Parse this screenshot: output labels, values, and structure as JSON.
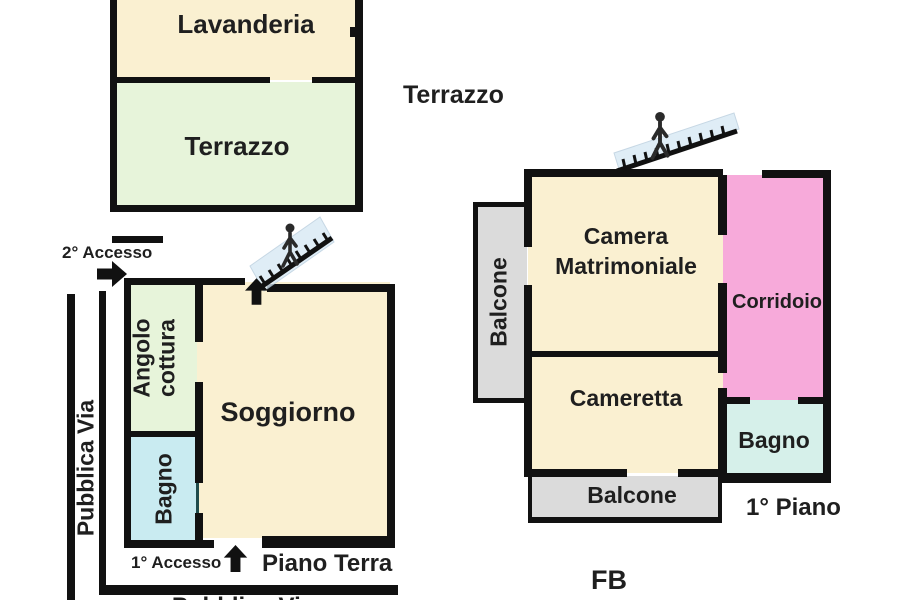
{
  "labels": {
    "lavanderia": "Lavanderia",
    "terrazzo_room": "Terrazzo",
    "terrazzo_outer": "Terrazzo",
    "accesso2": "2° Accesso",
    "accesso1": "1° Accesso",
    "pubblica_via_left": "Pubblica Via",
    "pubblica_via_bottom": "Pubblica Via",
    "angolo_line1": "Angolo",
    "angolo_line2": "cottura",
    "soggiorno": "Soggiorno",
    "bagno_ground": "Bagno",
    "piano_terra": "Piano Terra",
    "balcone_left": "Balcone",
    "camera_line1": "Camera",
    "camera_line2": "Matrimoniale",
    "cameretta": "Cameretta",
    "corridoio": "Corridoio",
    "bagno_first": "Bagno",
    "balcone_bottom": "Balcone",
    "piano_primo": "1° Piano",
    "signature": "FB"
  },
  "colors": {
    "wall": "#111111",
    "text": "#1f1f1f",
    "cream": "#FAF0D1",
    "green": "#E7F4DA",
    "cyan_ground": "#C9EBF1",
    "teal_border": "#1F4B4B",
    "cyan_first": "#D6F0EA",
    "pink": "#F7AADA",
    "gray": "#DBDBDB",
    "stair_fill": "#D8E9F5"
  }
}
